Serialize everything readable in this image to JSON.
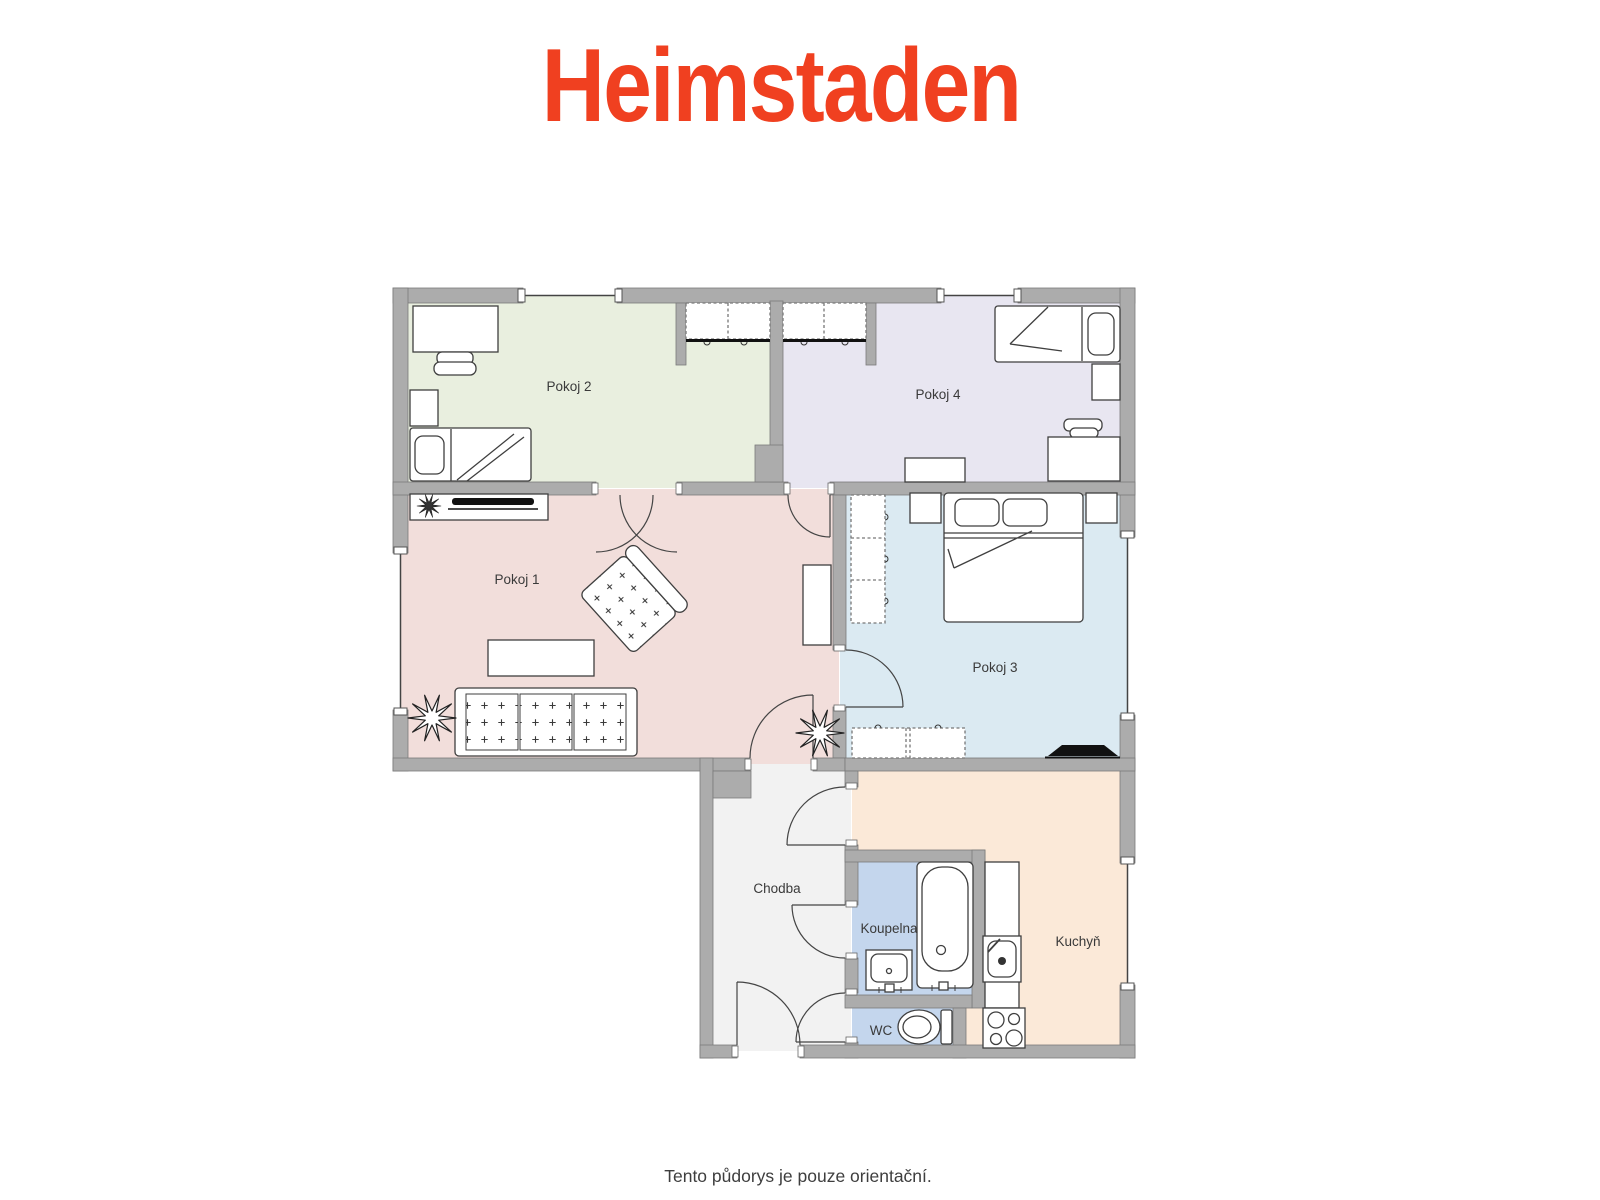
{
  "header": {
    "logo_text": "Heimstaden",
    "logo_color": "#F04020"
  },
  "floorplan": {
    "wall_color": "#ACACAC",
    "rooms": [
      {
        "id": "pokoj-1",
        "label": "Pokoj 1",
        "color": "#F2DEDB"
      },
      {
        "id": "pokoj-2",
        "label": "Pokoj 2",
        "color": "#E9EFDF"
      },
      {
        "id": "pokoj-3",
        "label": "Pokoj 3",
        "color": "#DBEAF2"
      },
      {
        "id": "pokoj-4",
        "label": "Pokoj 4",
        "color": "#E8E6F1"
      },
      {
        "id": "chodba",
        "label": "Chodba",
        "color": "#F2F2F2"
      },
      {
        "id": "koupelna",
        "label": "Koupelna",
        "color": "#C4D6ED"
      },
      {
        "id": "wc",
        "label": "WC",
        "color": "#C4D6ED"
      },
      {
        "id": "kuchyn",
        "label": "Kuchyň",
        "color": "#FBE9D8"
      }
    ]
  },
  "footer": {
    "caption": "Tento půdorys je pouze orientační."
  }
}
